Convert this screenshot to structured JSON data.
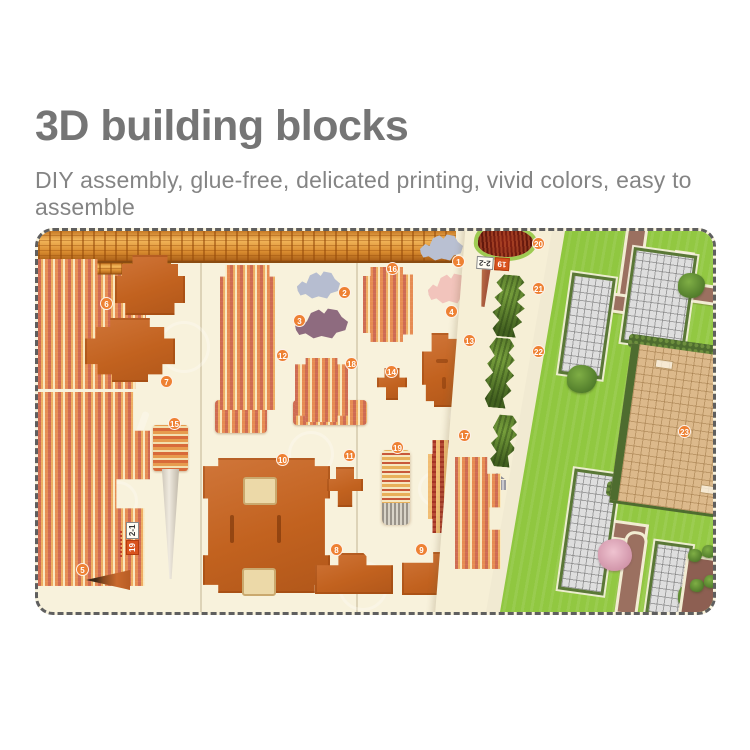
{
  "header": {
    "title": "3D building blocks",
    "subtitle": "DIY assembly, glue-free, delicated printing, vivid colors, easy to assemble"
  },
  "photo": {
    "description": "die-cut 3D puzzle sheets of a palace model with garden base board",
    "sheet_labels": {
      "sheet1_number": "19",
      "sheet1_code": "2-1",
      "sheet2_number": "19",
      "sheet2_code": "2-2"
    },
    "badges": [
      {
        "label": "1",
        "x": 414,
        "y": 24
      },
      {
        "label": "2",
        "x": 300,
        "y": 55
      },
      {
        "label": "3",
        "x": 255,
        "y": 83
      },
      {
        "label": "4",
        "x": 407,
        "y": 74
      },
      {
        "label": "5",
        "x": 38,
        "y": 332
      },
      {
        "label": "6",
        "x": 62,
        "y": 66
      },
      {
        "label": "7",
        "x": 122,
        "y": 144
      },
      {
        "label": "8",
        "x": 292,
        "y": 312
      },
      {
        "label": "9",
        "x": 377,
        "y": 312
      },
      {
        "label": "10",
        "x": 238,
        "y": 222
      },
      {
        "label": "11",
        "x": 305,
        "y": 218
      },
      {
        "label": "12",
        "x": 238,
        "y": 118
      },
      {
        "label": "13",
        "x": 425,
        "y": 103
      },
      {
        "label": "14",
        "x": 347,
        "y": 134
      },
      {
        "label": "15",
        "x": 130,
        "y": 186
      },
      {
        "label": "16",
        "x": 348,
        "y": 31
      },
      {
        "label": "17",
        "x": 420,
        "y": 198
      },
      {
        "label": "18",
        "x": 307,
        "y": 126
      },
      {
        "label": "19",
        "x": 353,
        "y": 210
      },
      {
        "label": "20",
        "x": 494,
        "y": 6
      },
      {
        "label": "21",
        "x": 494,
        "y": 51
      },
      {
        "label": "22",
        "x": 494,
        "y": 114
      },
      {
        "label": "23",
        "x": 640,
        "y": 194
      }
    ],
    "colors": {
      "title_gray": "#757575",
      "subtitle_gray": "#848484",
      "sheet_cream": "#f8f2dc",
      "piece_orange": "#c2621f",
      "badge_orange": "#ee8133",
      "cloud_blue": "#b6bdd0",
      "cloud_purple": "#8e6b7f",
      "cloud_pink": "#f2c4bc",
      "grass_green": "#8cc63d",
      "hedge_green": "#4e6c2f",
      "path_brown": "#9b7060",
      "plaza_tan": "#dcb98b",
      "grid_gray": "#dedede",
      "gold_beam": "#e9a33e"
    }
  }
}
